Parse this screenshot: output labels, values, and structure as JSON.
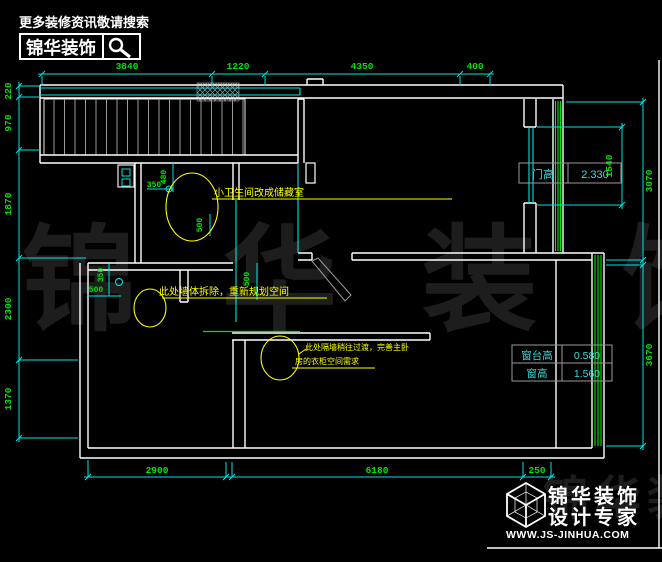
{
  "header": {
    "tagline": "更多装修资讯敬请搜索",
    "brand": "锦华装饰"
  },
  "watermark": {
    "main": "锦华装饰",
    "corner": "锦华装"
  },
  "dims": {
    "top": [
      "3840",
      "1220",
      "4350",
      "400"
    ],
    "left": [
      "220",
      "970",
      "1870",
      "2300",
      "1370"
    ],
    "right": [
      "1540",
      "3070",
      "3670"
    ],
    "bottom": [
      "2900",
      "6180",
      "250"
    ],
    "interior": {
      "storage_width": "350",
      "storage_height": "480",
      "bed_height": "350",
      "bed_width": "500",
      "wall_offset": "500",
      "wall_offset2": "500"
    }
  },
  "tables": {
    "door": {
      "label": "门高",
      "value": "2.330"
    },
    "window_sill": {
      "label": "窗台高",
      "value": "0.580"
    },
    "window": {
      "label": "窗高",
      "value": "1.560"
    }
  },
  "annotations": {
    "storage": "小卫生间改成储藏室",
    "demolish": "此处墙体拆除，重新规划空间",
    "partition_line1": "此处隔墙稍往过渡，完善主卧",
    "partition_line2": "房的衣柜空间需求"
  },
  "footer": {
    "brand": "锦华装饰",
    "subtitle": "设计专家",
    "website": "WWW.JS-JINHUA.COM"
  }
}
